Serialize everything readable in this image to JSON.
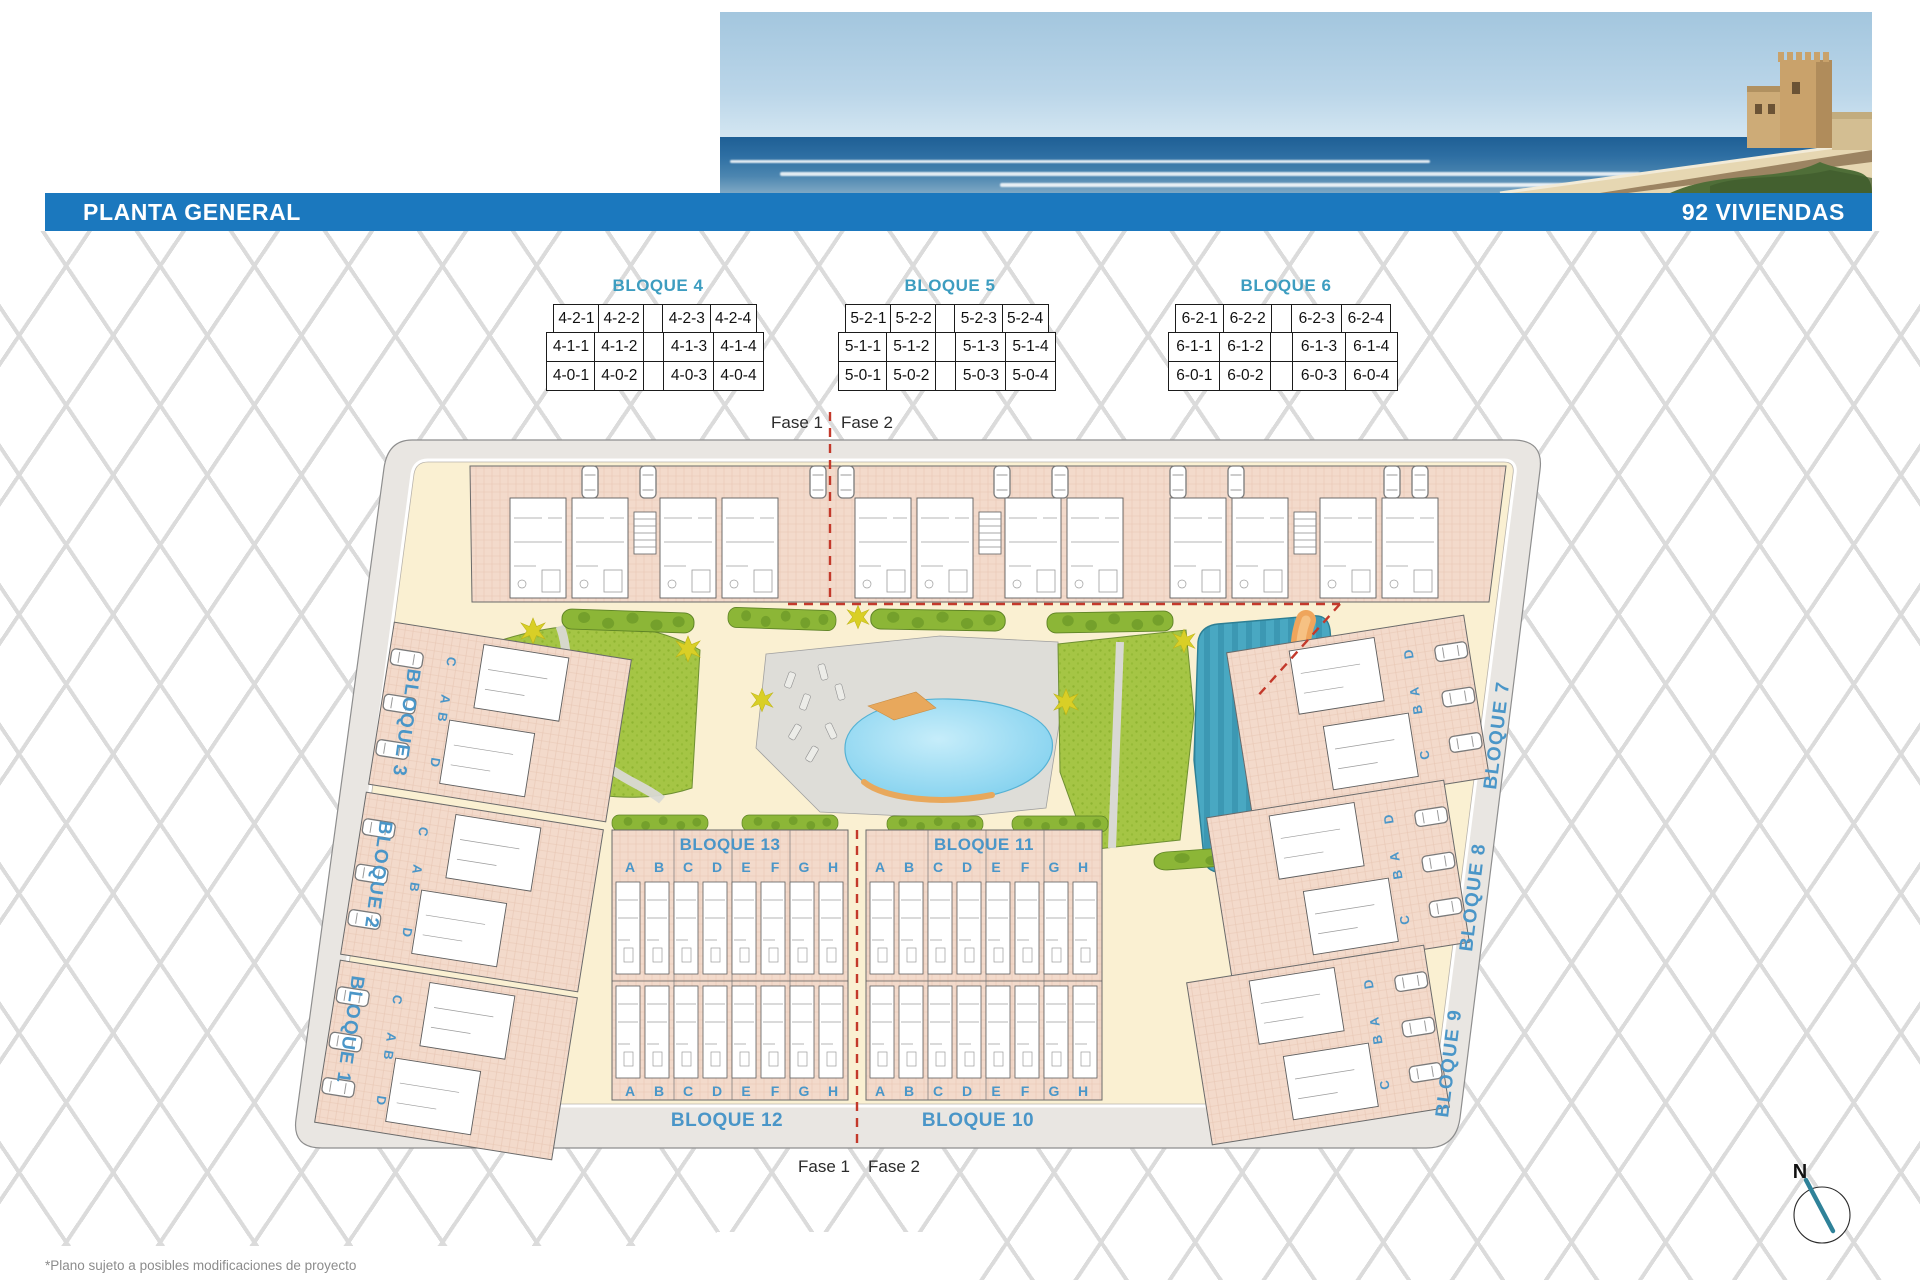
{
  "header": {
    "title": "PLANTA GENERAL",
    "units_count": "92 VIVIENDAS"
  },
  "unit_tables": [
    {
      "title": "BLOQUE 4",
      "rows": [
        [
          "4-2-1",
          "4-2-2",
          "",
          "4-2-3",
          "4-2-4"
        ],
        [
          "4-1-1",
          "4-1-2",
          "",
          "4-1-3",
          "4-1-4"
        ],
        [
          "4-0-1",
          "4-0-2",
          "",
          "4-0-3",
          "4-0-4"
        ]
      ]
    },
    {
      "title": "BLOQUE 5",
      "rows": [
        [
          "5-2-1",
          "5-2-2",
          "",
          "5-2-3",
          "5-2-4"
        ],
        [
          "5-1-1",
          "5-1-2",
          "",
          "5-1-3",
          "5-1-4"
        ],
        [
          "5-0-1",
          "5-0-2",
          "",
          "5-0-3",
          "5-0-4"
        ]
      ]
    },
    {
      "title": "BLOQUE 6",
      "rows": [
        [
          "6-2-1",
          "6-2-2",
          "",
          "6-2-3",
          "6-2-4"
        ],
        [
          "6-1-1",
          "6-1-2",
          "",
          "6-1-3",
          "6-1-4"
        ],
        [
          "6-0-1",
          "6-0-2",
          "",
          "6-0-3",
          "6-0-4"
        ]
      ]
    }
  ],
  "fase": {
    "fase1": "Fase 1",
    "fase2": "Fase 2"
  },
  "plan": {
    "left_labels": [
      "BLOQUE 3",
      "BLOQUE 2",
      "BLOQUE 1"
    ],
    "right_labels": [
      "BLOQUE 7",
      "BLOQUE 8",
      "BLOQUE 9"
    ],
    "bottom_labels_upper": [
      "BLOQUE 13",
      "BLOQUE 11"
    ],
    "bottom_labels_lower": [
      "BLOQUE 12",
      "BLOQUE 10"
    ],
    "unit_letters": [
      "A",
      "B",
      "C",
      "D",
      "E",
      "F",
      "G",
      "H"
    ],
    "cluster_letters_left": [
      "C",
      "A",
      "B",
      "D"
    ],
    "cluster_letters_right": [
      "D",
      "A",
      "B",
      "C"
    ],
    "compass_north": "N"
  },
  "footnote": "*Plano sujeto a posibles modificaciones de proyecto",
  "colors": {
    "banner_blue": "#1B78BE",
    "label_blue": "#4A96C8",
    "table_title_teal": "#3D9DC0",
    "fase_red": "#C3392B",
    "building_pink": "#F3DACB",
    "path_cream": "#FAF0D2",
    "road_gray": "#E9E6E2",
    "lawn_green": "#A5C545",
    "pool_blue": "#74CBEC",
    "teal_zone": "#49A8C2",
    "orange_accent": "#EFA55C"
  }
}
